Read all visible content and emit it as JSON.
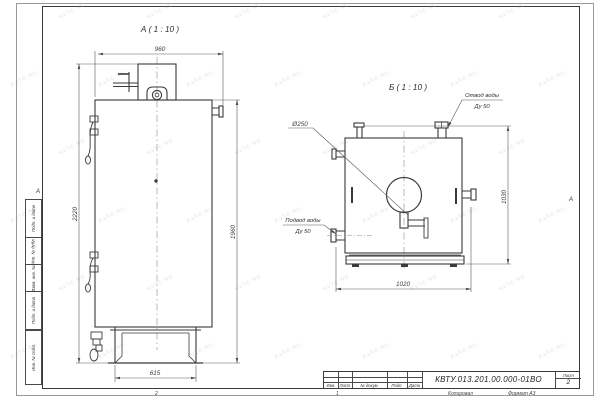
{
  "watermark": {
    "text": "KVTC.RU"
  },
  "frame": {
    "zone_left": "А",
    "zone_right": "А",
    "zone_bottom_first": "2",
    "zone_bottom_second": "1"
  },
  "side_stamp": {
    "cells": [
      "Подп. и дата",
      "Инв. № дубл.",
      "Взам. инв. №",
      "Подп. и дата",
      "Инв. № подл."
    ]
  },
  "title_block": {
    "doc_number": "КВТУ.013.201.00.000-01ВО",
    "sheet_label": "Лист",
    "sheet_number": "2",
    "revision_columns": [
      "Изм.",
      "Лист",
      "№ докум.",
      "Подп.",
      "Дата"
    ],
    "copied_label": "Копировал",
    "format_label": "Формат А3"
  },
  "view_a": {
    "label": "А ( 1 : 10 )",
    "dim_top": "960",
    "dim_left": "2220",
    "dim_right": "1960",
    "dim_bottom": "615"
  },
  "view_b": {
    "label": "Б ( 1 : 10 )",
    "dim_bottom": "1020",
    "dim_right": "1030",
    "dia_label": "Ø250",
    "outlet": {
      "line1": "Отвод воды",
      "line2": "Ду 50"
    },
    "inlet": {
      "line1": "Подвод воды",
      "line2": "Ду 50"
    }
  }
}
